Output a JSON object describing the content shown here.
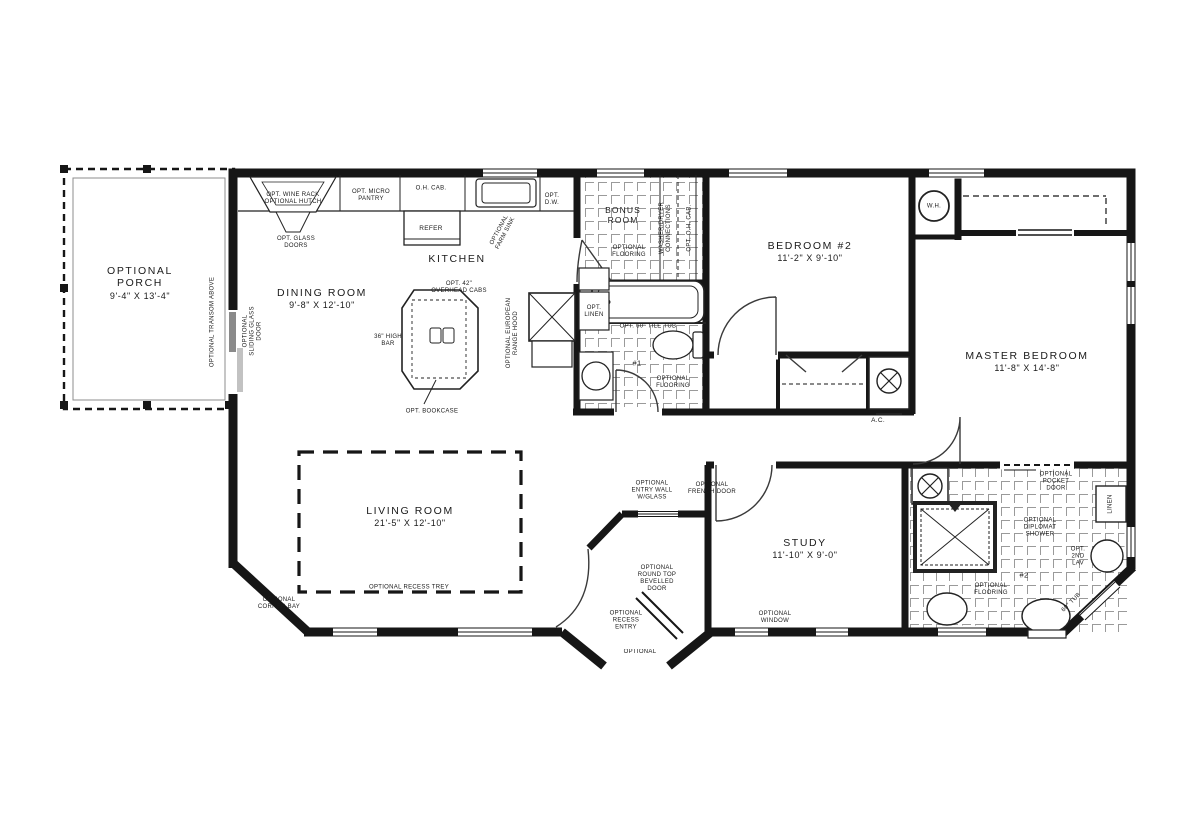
{
  "rooms": {
    "porch": {
      "name": "OPTIONAL PORCH",
      "dims": "9'-4\" X 13'-4\""
    },
    "dining": {
      "name": "DINING ROOM",
      "dims": "9'-8\" X 12'-10\""
    },
    "kitchen": {
      "name": "KITCHEN"
    },
    "bonus": {
      "name": "BONUS ROOM"
    },
    "bedroom2": {
      "name": "BEDROOM #2",
      "dims": "11'-2\" X 9'-10\""
    },
    "master": {
      "name": "MASTER BEDROOM",
      "dims": "11'-8\" X 14'-8\""
    },
    "living": {
      "name": "LIVING ROOM",
      "dims": "21'-5\" X 12'-10\""
    },
    "study": {
      "name": "STUDY",
      "dims": "11'-10\" X 9'-0\""
    }
  },
  "annotations": {
    "transom": "OPTIONAL TRANSOM ABOVE",
    "sliding_glass_door": "OPTIONAL SLIDING GLASS DOOR",
    "wine_rack": "OPT. WINE RACK",
    "hutch": "OPTIONAL HUTCH",
    "glass_doors": "OPT. GLASS DOORS",
    "micro_pantry": "OPT. MICRO PANTRY",
    "oh_cab": "O.H. CAB.",
    "refer": "REFER",
    "farm_sink": "OPTIONAL FARM SINK",
    "dw": "OPT. D.W.",
    "overhead_cabs": "OPT. 42\" OVERHEAD CABS",
    "high_bar": "36\" HIGH BAR",
    "range_hood": "OPTIONAL EUROPEAN RANGE HOOD",
    "bookcase": "OPT. BOOKCASE",
    "bonus_flooring": "OPTIONAL FLOORING",
    "wd": "WASHER/DRYER CONNECTIONS",
    "opt_oh_cab": "OPT. O.H. CAB.",
    "wh": "W.H.",
    "opt_linen": "OPT. LINEN",
    "tile_tub": "OPT. 60\" TILE TUB",
    "bath1": "#1",
    "bath1_flooring": "OPTIONAL FLOORING",
    "ac": "A.C.",
    "recess_trey": "OPTIONAL RECESS TREY",
    "corner_bay": "OPTIONAL CORNER BAY",
    "entry_wall": "OPTIONAL ENTRY WALL W/GLASS",
    "french_door": "OPTIONAL FRENCH DOOR",
    "round_top_door": "OPTIONAL ROUND TOP BEVELLED DOOR",
    "recess_entry": "OPTIONAL RECESS ENTRY",
    "entry_cutoff": "OPTIONAL",
    "window": "OPTIONAL WINDOW",
    "pocket_door": "OPTIONAL POCKET DOOR",
    "diplomat_shower": "OPTIONAL DIPLOMAT SHOWER",
    "bath2": "#2",
    "bath2_flooring": "OPTIONAL FLOORING",
    "second_lav": "OPT. 2ND LAV",
    "linen": "LINEN",
    "tub_60": "60\" TUB"
  },
  "colors": {
    "line": "#161616",
    "tile": "#9a9a9a",
    "background": "#ffffff"
  }
}
